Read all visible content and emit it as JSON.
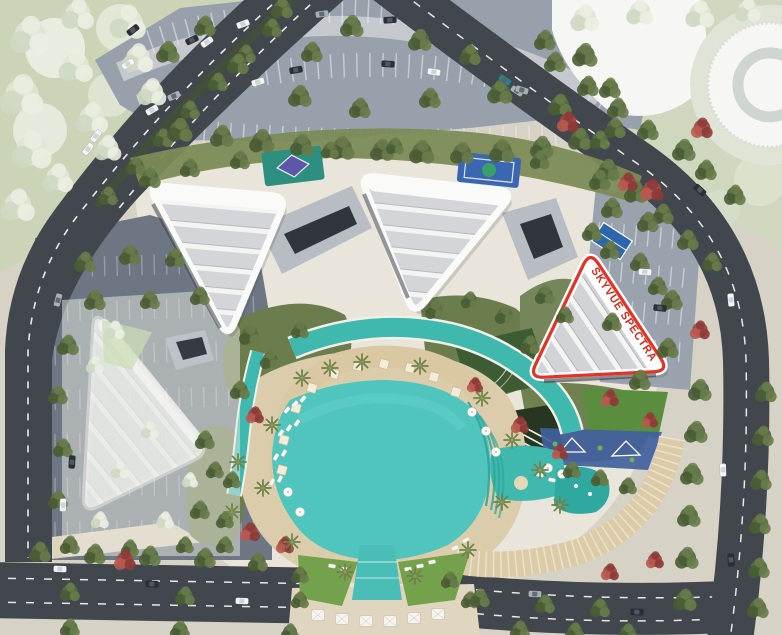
{
  "highlight": {
    "label": "SKYVUE SPECTRA",
    "outline_color": "#e63224",
    "label_color": "#d62b1c",
    "band_color": "#ffffff"
  },
  "palette": {
    "ground_sand": "#e9e5da",
    "deck_beige": "#dbcdab",
    "daybed_band": "#d9c8a2",
    "pool_teal": "#4fc5be",
    "pool_teal_dark": "#2da49a",
    "lap_teal": "#3fb8ae",
    "road_asphalt": "#42474e",
    "parking_gray": "#98a1ab",
    "parking_gray_dark": "#6d7683",
    "greenery_olive": "#6b7c4d",
    "lawn_dark": "#3d5c33",
    "park_pale_green": "#cbd4b6",
    "building_white": "#f6f6f4",
    "roof_stripe_gray": "#d4d5d8",
    "bridge_gray": "#b8bdc4",
    "facade_dark": "#30363c"
  },
  "features": [
    "triangular-residential-towers",
    "highlighted-tower-plot",
    "central-lagoon-pool",
    "lap-pools",
    "kids-splash-pool",
    "pool-deck",
    "sports-courts",
    "playground",
    "landscaped-gardens",
    "surface-parking",
    "access-roads",
    "circular-pavilion"
  ]
}
